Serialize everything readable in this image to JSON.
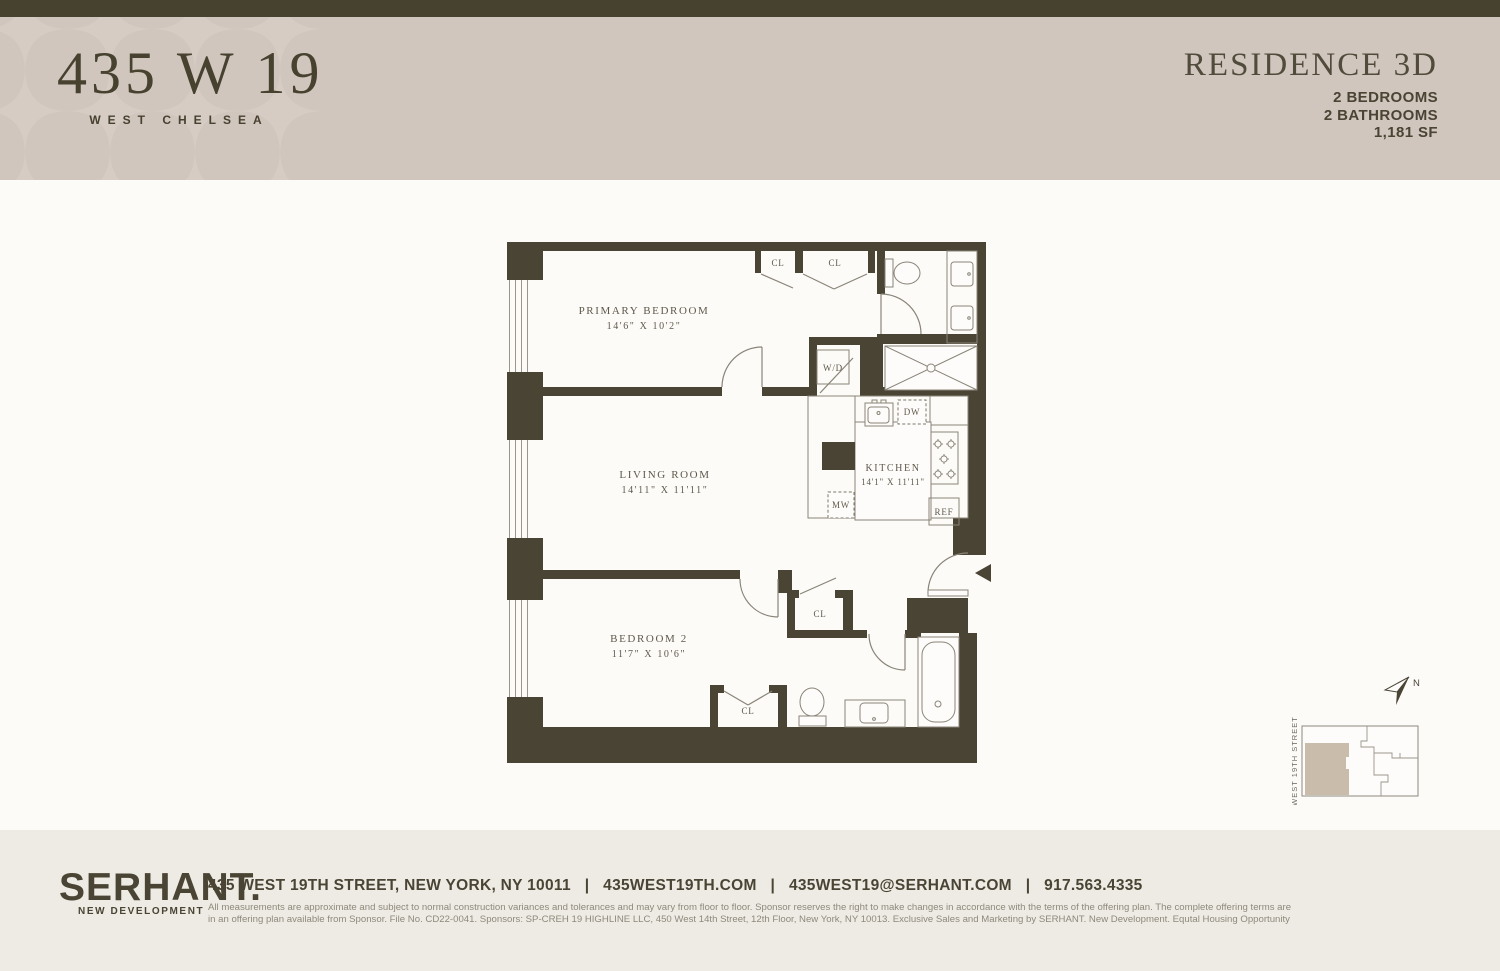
{
  "header": {
    "building_name": "435 W 19",
    "building_subtitle": "WEST CHELSEA",
    "residence_title": "RESIDENCE 3D",
    "spec_bedrooms": "2 BEDROOMS",
    "spec_bathrooms": "2 BATHROOMS",
    "spec_area": "1,181 SF"
  },
  "floorplan": {
    "rooms": [
      {
        "name": "PRIMARY BEDROOM",
        "dims": "14'6\" X 10'2\""
      },
      {
        "name": "LIVING ROOM",
        "dims": "14'11\" X 11'11\""
      },
      {
        "name": "KITCHEN",
        "dims": "14'1\" X 11'11\""
      },
      {
        "name": "BEDROOM 2",
        "dims": "11'7\" X 10'6\""
      }
    ],
    "labels": {
      "closet": "CL",
      "washer_dryer": "W/D",
      "dishwasher": "DW",
      "microwave": "MW",
      "refrigerator": "REF"
    }
  },
  "keyplan": {
    "street_label": "WEST 19TH STREET",
    "north_label": "N"
  },
  "footer": {
    "brand": "SERHANT.",
    "brand_sub": "NEW DEVELOPMENT",
    "contact": "435 WEST 19TH STREET, NEW YORK, NY 10011   |   435WEST19TH.COM   |   435WEST19@SERHANT.COM   |   917.563.4335",
    "disclaimer_line1": "All measurements are approximate and subject to normal construction variances and tolerances and may vary from floor to floor. Sponsor reserves the right to make changes in accordance with the terms of the offering plan. The complete offering terms are",
    "disclaimer_line2": "in an offering plan available from Sponsor. File No. CD22-0041. Sponsors: SP-CREH 19 HIGHLINE LLC, 450 West 14th Street, 12th Floor, New York, NY 10013. Exclusive Sales and Marketing by SERHANT. New Development. Equtal Housing Opportunity"
  },
  "colors": {
    "brand_dark": "#474130",
    "header_beige": "#d1c6bd",
    "footer_beige": "#edebe4",
    "wall": "#4a4434",
    "keyplan_highlight": "#c9bcab"
  }
}
